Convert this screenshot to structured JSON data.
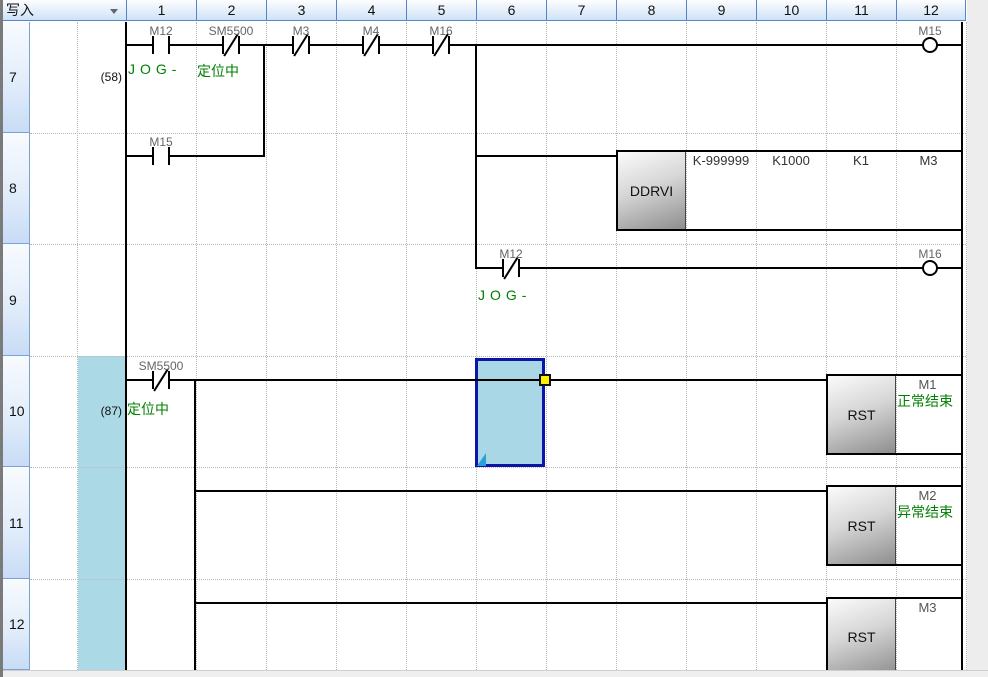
{
  "titlebar": {
    "mode_label": "写入",
    "dropdown_icon": "caret-down"
  },
  "grid": {
    "columns": [
      "1",
      "2",
      "3",
      "4",
      "5",
      "6",
      "7",
      "8",
      "9",
      "10",
      "11",
      "12"
    ],
    "rows": [
      "7",
      "8",
      "9",
      "10",
      "11",
      "12"
    ]
  },
  "steps": {
    "rung7": "(58)",
    "rung10": "(87)"
  },
  "ladder": {
    "r7": {
      "c1": {
        "device": "M12",
        "comment": "JOG-"
      },
      "c2": {
        "device": "SM5500",
        "comment": "定位中"
      },
      "c3": {
        "device": "M3"
      },
      "c4": {
        "device": "M4"
      },
      "c5": {
        "device": "M16"
      },
      "coil": {
        "device": "M15"
      }
    },
    "r8": {
      "c1": {
        "device": "M15"
      }
    },
    "r9": {
      "c6": {
        "device": "M12",
        "comment": "JOG-"
      },
      "coil": {
        "device": "M16"
      }
    },
    "r10": {
      "c1": {
        "device": "SM5500",
        "comment": "定位中"
      }
    }
  },
  "instructions": {
    "ddrvi": {
      "mnemonic": "DDRVI",
      "p1": "K-999999",
      "p2": "K1000",
      "p3": "K1",
      "p4": "M3"
    },
    "rst1": {
      "mnemonic": "RST",
      "param": "M1",
      "comment": "正常结束"
    },
    "rst2": {
      "mnemonic": "RST",
      "param": "M2",
      "comment": "异常结束"
    },
    "rst3": {
      "mnemonic": "RST",
      "param": "M3"
    }
  },
  "colors": {
    "selection_fill": "#a9d7e6",
    "selection_border": "#0b16a8",
    "edit_band": "#abdae6",
    "comment_green": "#008000",
    "handle_yellow": "#ffee00"
  }
}
